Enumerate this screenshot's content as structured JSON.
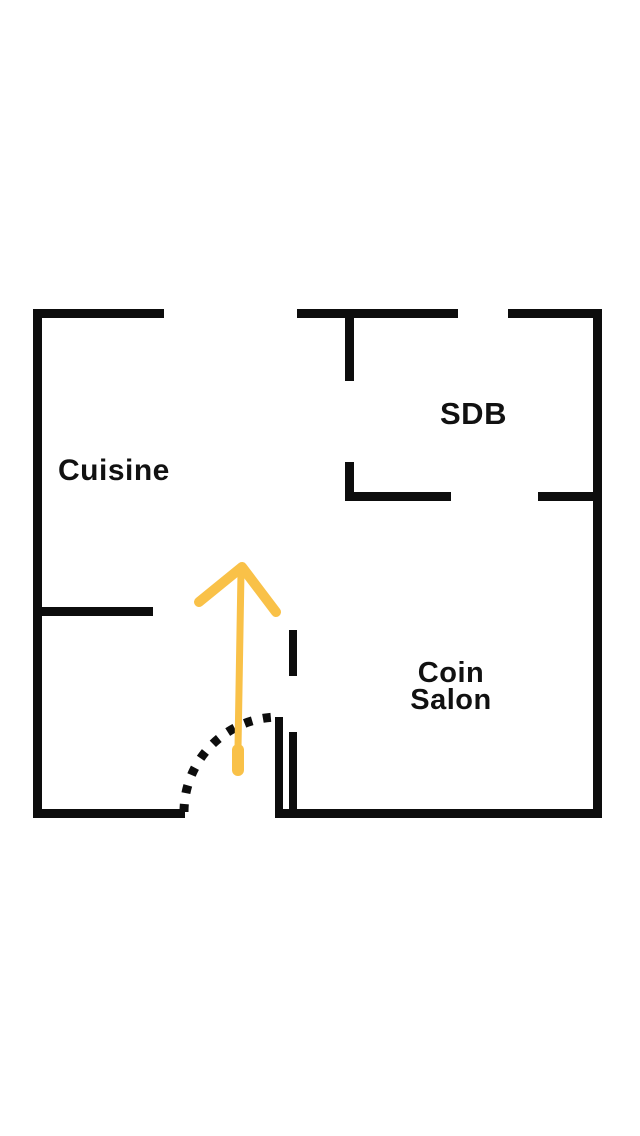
{
  "page": {
    "type": "floor-plan"
  },
  "colors": {
    "background": "#ffffff",
    "wall": "#0d0d0d",
    "accent_arrow": "#F9C148",
    "label_text": "#111111"
  },
  "rooms": {
    "cuisine": {
      "label": "Cuisine"
    },
    "sdb": {
      "label": "SDB"
    },
    "coin_salon": {
      "line1": "Coin",
      "line2": "Salon"
    }
  },
  "annotations": {
    "entrance_arrow_icon": "up-arrow-icon",
    "door_swing": "dashed-quarter-arc"
  }
}
